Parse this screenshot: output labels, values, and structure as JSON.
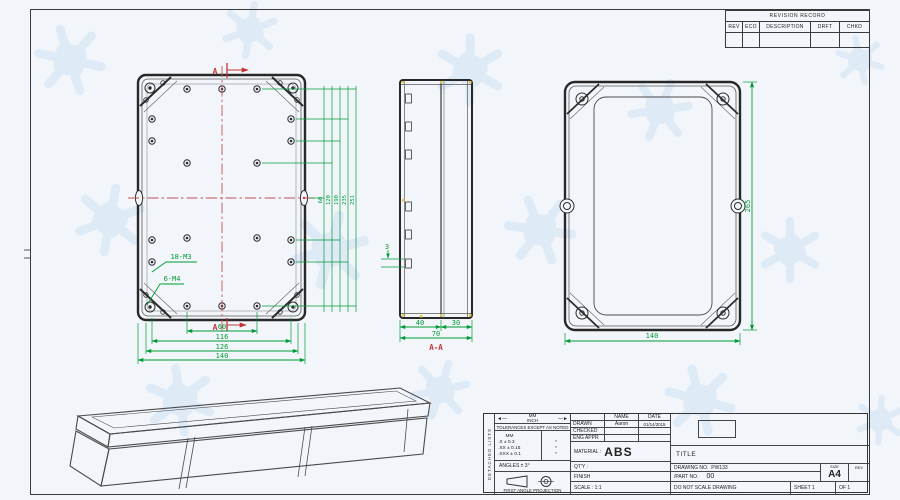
{
  "revision_table": {
    "title": "REVISION RECORD",
    "col_rev": "REV",
    "col_eco": "ECO",
    "col_description": "DESCRIPTION",
    "col_drft": "DRFT",
    "col_chkd": "CHKD"
  },
  "front_view": {
    "dim_60": "60",
    "dim_116": "116",
    "dim_126": "126",
    "dim_140": "140",
    "holes_label": "18-M3",
    "bosses_label": "6-M4",
    "section_letter": "A",
    "side_dims": [
      "60",
      "120",
      "190",
      "235",
      "251"
    ]
  },
  "section_view": {
    "dim_tab": "3",
    "dim_40": "40",
    "dim_30": "30",
    "dim_70": "70",
    "label": "A-A"
  },
  "right_view": {
    "dim_height": "265",
    "dim_width": "140"
  },
  "title_block": {
    "side_label": "DETACHED LISTS",
    "unit_top": "MM",
    "unit_bottom": "INCH",
    "tol_note": "TOLERANCES EXCEPT AS NOTED",
    "tol_unit": "MM",
    "tol_rows": [
      ".X ± 0.3",
      ".XX ± 0.15",
      ".XXX ± 0.1"
    ],
    "tol_marks": [
      "*",
      "*",
      "*"
    ],
    "angles": "ANGLES ± 3°",
    "projection": "FIRST ANGLE PROJECTION",
    "name_header": "NAME",
    "date_header": "DATE",
    "drawn_label": "DRAWN",
    "drawn_name": "Aaron",
    "drawn_date": "01/14/2015",
    "checked_label": "CHECKED",
    "eng_label": "ENG APPR",
    "material_label": "MATERIAL :",
    "material_value": "ABS",
    "qty_label": "QT'Y :",
    "finish_label": "FINISH",
    "scale_label": "SCALE : 1:1",
    "title_label": "TITLE",
    "drawing_no_label": "DRAWING NO.",
    "drawing_no": "PW133",
    "part_no_label": "/PART  NO.",
    "part_no": "00",
    "size_label": "SIZE",
    "size_value": "A4",
    "rev_label": "REV",
    "do_not_scale": "DO NOT SCALE DRAWING",
    "sheet_label": "SHEET 1",
    "of_label": "OF 1"
  }
}
